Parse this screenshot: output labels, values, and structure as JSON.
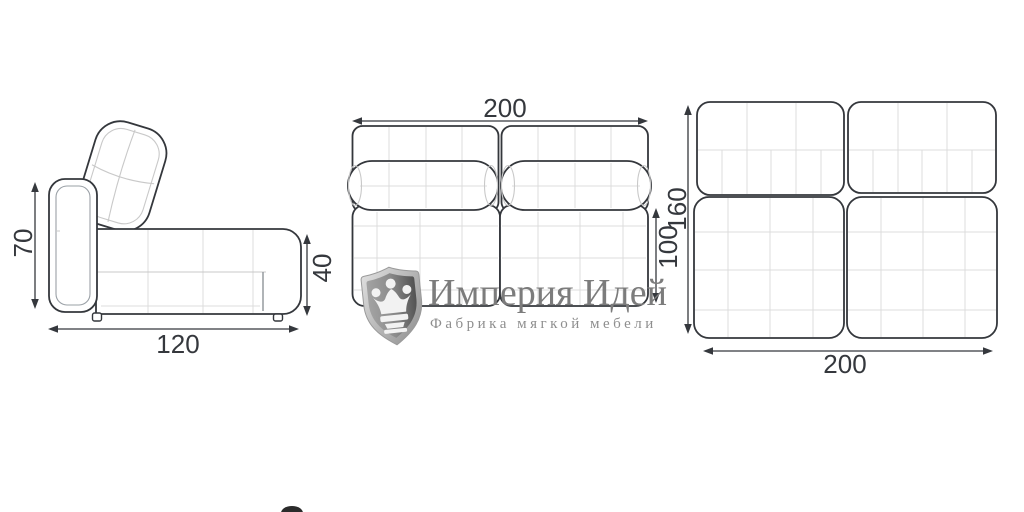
{
  "brand": {
    "name": "Империя Идей",
    "tagline": "Фабрика мягкой мебели",
    "logo_icon": "shield-crown-icon"
  },
  "views": {
    "side": {
      "height": "70",
      "length": "120",
      "seat_height": "40"
    },
    "front": {
      "width": "200",
      "height": "100"
    },
    "top": {
      "depth": "160",
      "width": "200"
    }
  },
  "palette": {
    "outline": "#34373c",
    "inner_seam": "#c9c9c9",
    "grid_line": "#dcdcdc",
    "dimension": "#35383d",
    "logo_text": "#7c7c7c",
    "logo_tagline": "#8e8e8e"
  }
}
